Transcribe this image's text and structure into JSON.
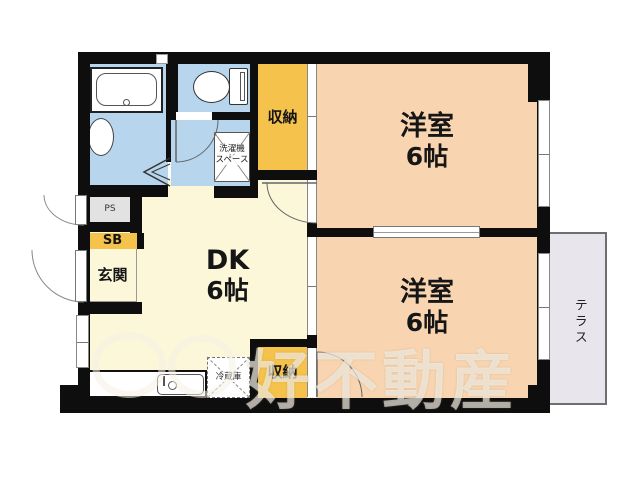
{
  "floorplan": {
    "rooms": {
      "bedroom1": {
        "name": "洋室",
        "size": "6帖"
      },
      "bedroom2": {
        "name": "洋室",
        "size": "6帖"
      },
      "dk": {
        "name": "DK",
        "size": "6帖"
      },
      "entrance": {
        "label": "玄関"
      },
      "shoe_box": {
        "label": "SB"
      },
      "pipe_space": {
        "label": "PS"
      },
      "closet_upper": {
        "label": "収納"
      },
      "closet_lower": {
        "label": "収納"
      },
      "laundry": {
        "line1": "洗濯機",
        "line2": "スペース"
      },
      "refrigerator": {
        "label": "冷蔵庫"
      },
      "terrace": {
        "label": "テラス"
      }
    },
    "watermark": {
      "text": "好不動産"
    },
    "colors": {
      "bedroom_peach": "#f8d5b0",
      "dk_cream": "#fbf7d8",
      "closet_orange": "#f5c24b",
      "wet_area_blue": "#b7d6ee",
      "pipe_space_gray": "#e3e2e2",
      "terrace_gray": "#e8e6ec",
      "wall_black": "#0e0e0e"
    }
  }
}
